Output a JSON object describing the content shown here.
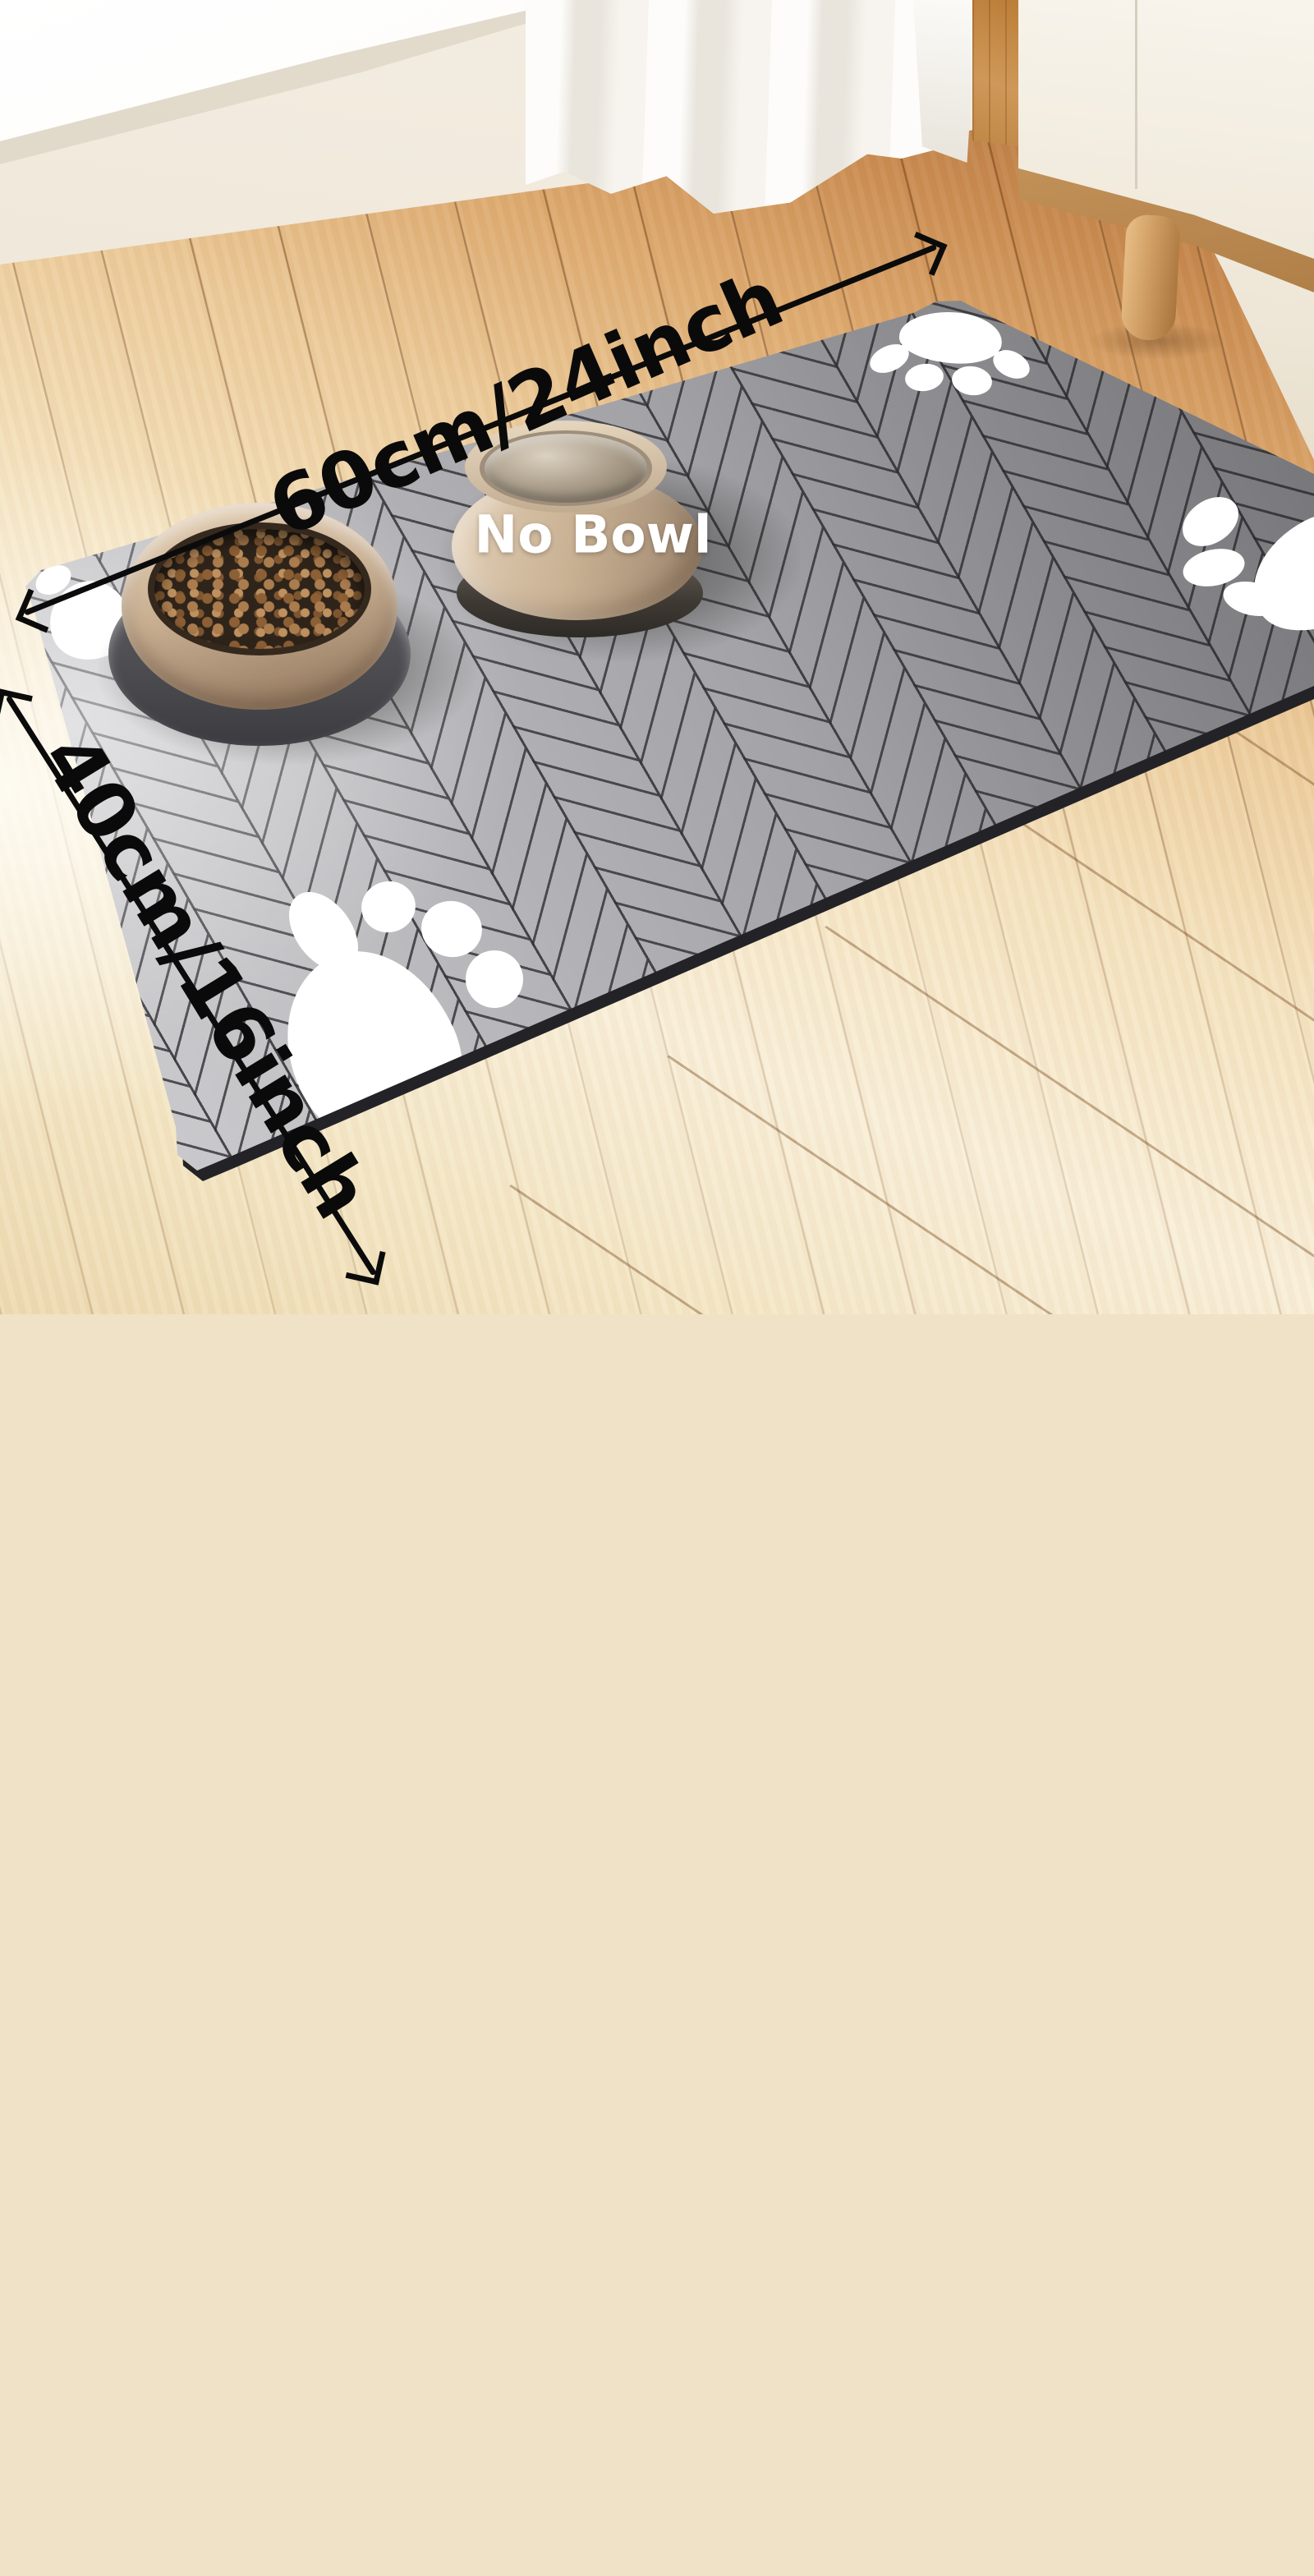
{
  "scene": {
    "description": "E-commerce product photo of a grey herringbone-pattern absorbent pet feeding mat on a wooden floor, with a kibble-filled food bowl and a water bowl, white paw-print graphics, and black dimension arrows",
    "annotations": {
      "width_label": "60cm/24inch",
      "height_label": "40cm/16inch",
      "no_bowl_label": "No Bowl"
    },
    "objects": {
      "mat": "grey herringbone feeding mat with dark edge",
      "bowls": [
        "food bowl with kibble",
        "water bowl"
      ],
      "paw_print_count": 4
    },
    "colors": {
      "mat_gray": "#a9a9ad",
      "mat_line": "#2f2f33",
      "mat_edge": "#232327",
      "arrow_black": "#0b0b0b",
      "floor_warm_wood": "#c98b50",
      "floor_pale_wood": "#f9efd9",
      "bowl_tan": "#c9b194",
      "kibble_brown": "#ab7c4e",
      "paw_white": "#ffffff",
      "label_white": "#ffffff"
    }
  }
}
